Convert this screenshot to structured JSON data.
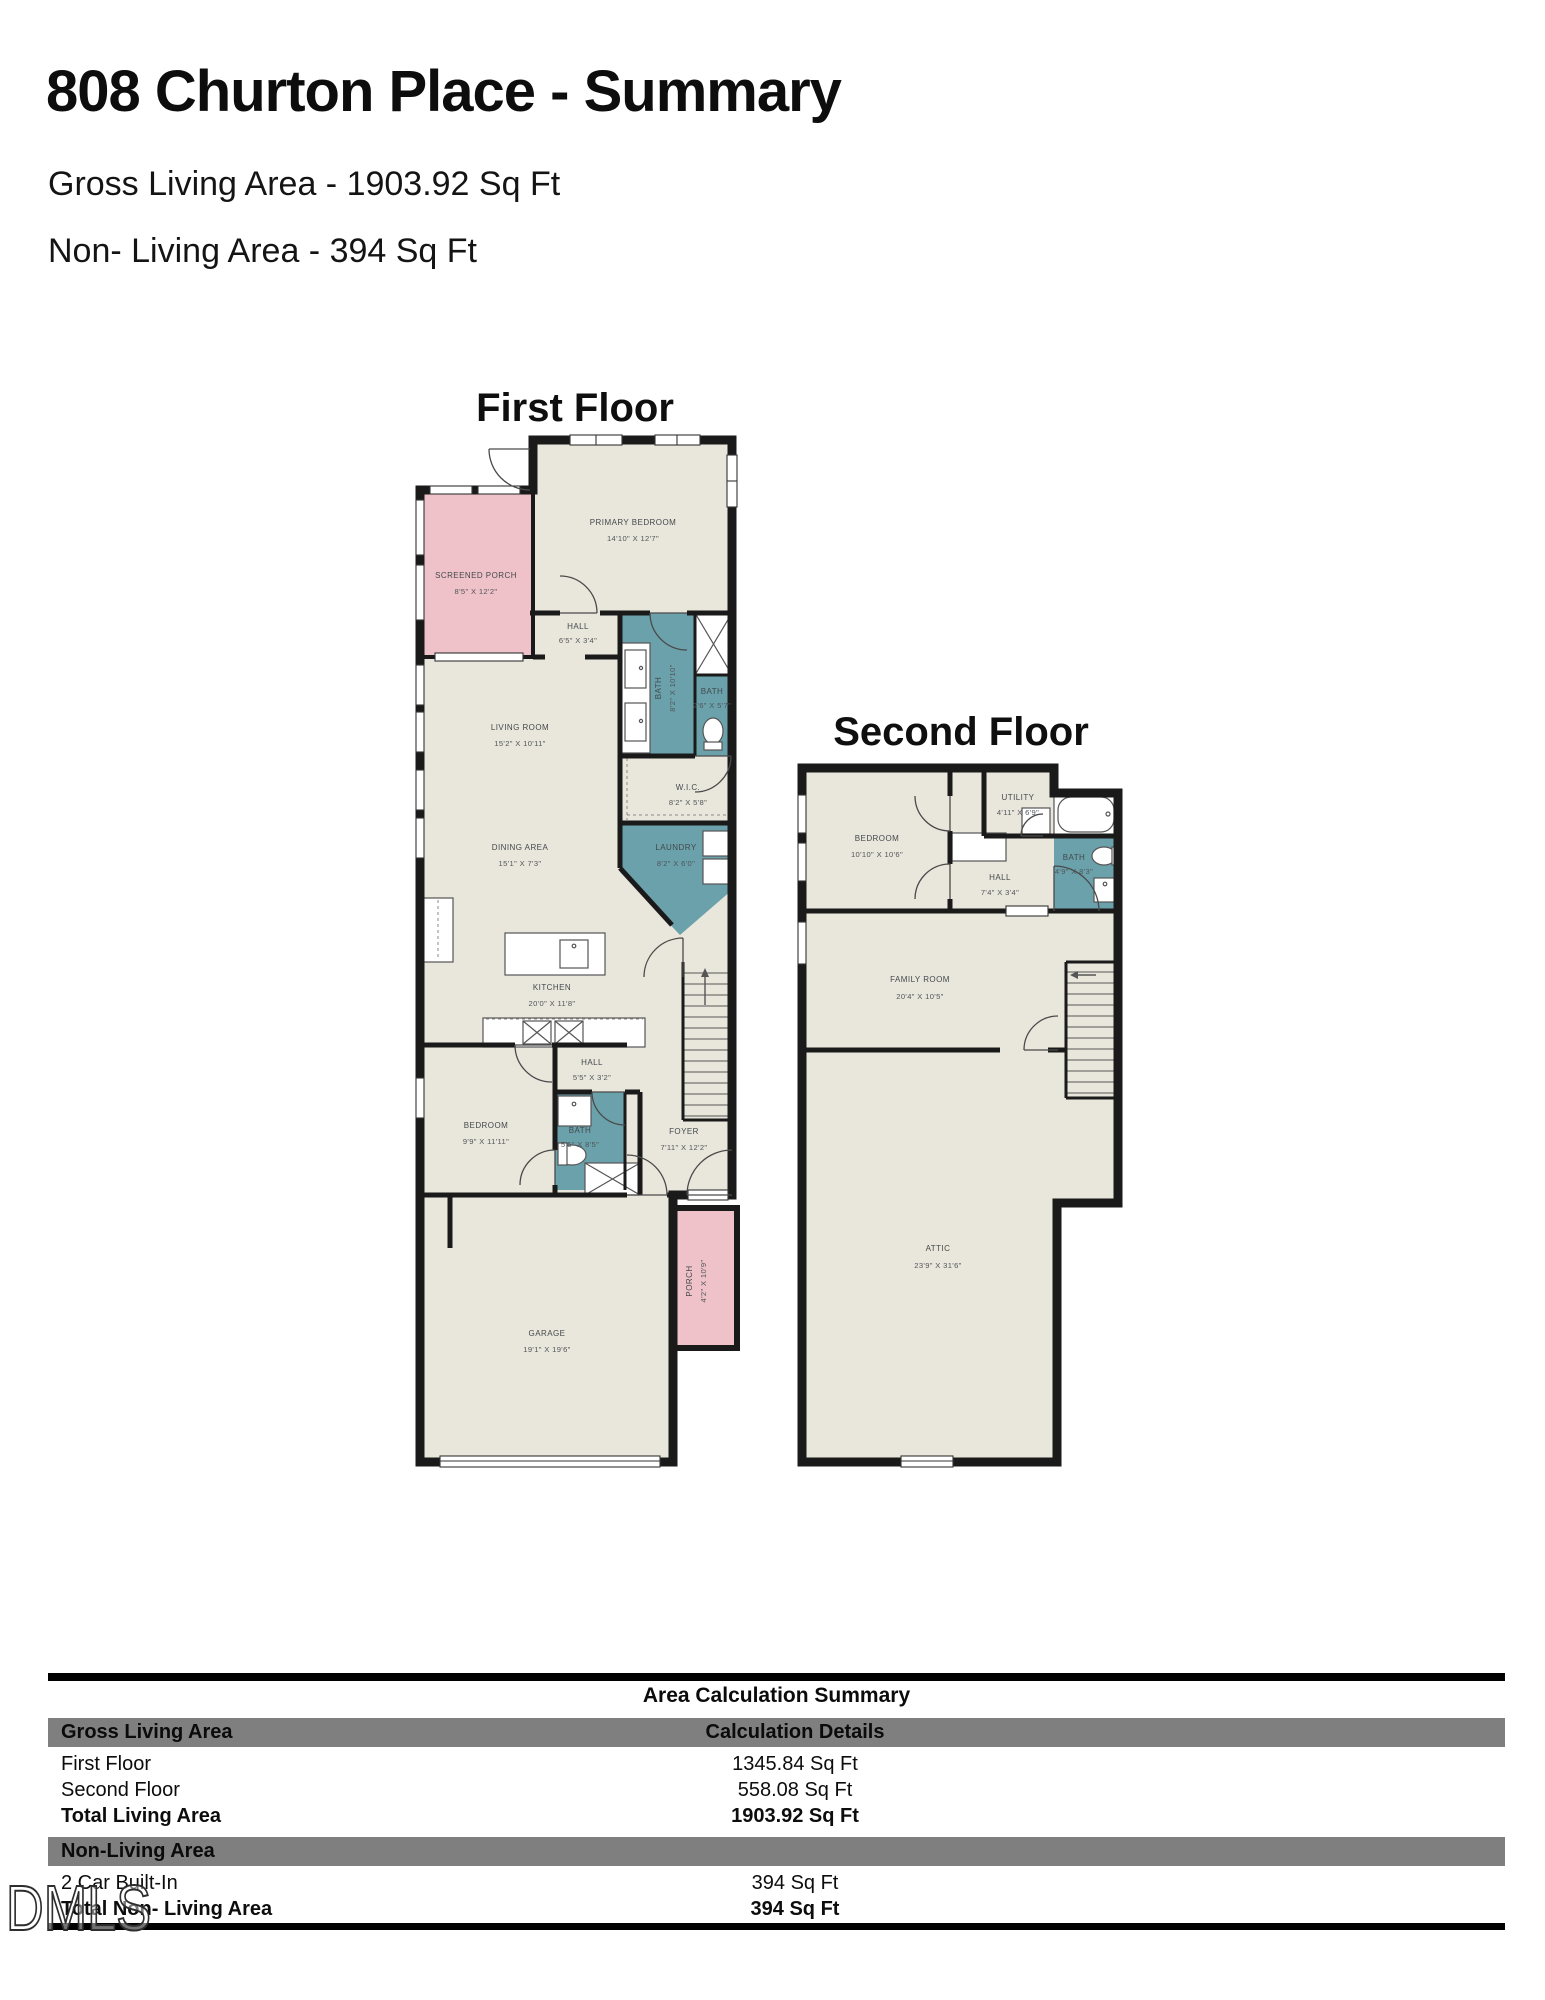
{
  "header": {
    "title": "808 Churton Place - Summary",
    "subtitle_gross": "Gross Living Area - 1903.92 Sq Ft",
    "subtitle_nonliving": "Non- Living Area - 394 Sq Ft"
  },
  "first_floor": {
    "heading": "First Floor",
    "rooms": {
      "screened_porch": {
        "name": "SCREENED PORCH",
        "dims": "8'5\" X 12'2\""
      },
      "primary_bedroom": {
        "name": "PRIMARY BEDROOM",
        "dims": "14'10\" X 12'7\""
      },
      "hall_upper": {
        "name": "HALL",
        "dims": "6'5\" X 3'4\""
      },
      "bath_primary": {
        "name": "BATH",
        "dims": "8'2\" X 10'10\""
      },
      "bath_small": {
        "name": "BATH",
        "dims": "2'6\" X 5'7\""
      },
      "living_room": {
        "name": "LIVING ROOM",
        "dims": "15'2\" X 10'11\""
      },
      "wic": {
        "name": "W.I.C.",
        "dims": "8'2\" X 5'8\""
      },
      "dining_area": {
        "name": "DINING AREA",
        "dims": "15'1\" X 7'3\""
      },
      "laundry": {
        "name": "LAUNDRY",
        "dims": "8'2\" X 6'0\""
      },
      "kitchen": {
        "name": "KITCHEN",
        "dims": "20'0\" X 11'8\""
      },
      "hall_lower": {
        "name": "HALL",
        "dims": "5'5\" X 3'2\""
      },
      "bedroom": {
        "name": "BEDROOM",
        "dims": "9'9\" X 11'11\""
      },
      "bath_hall": {
        "name": "BATH",
        "dims": "5'5\" X 8'5\""
      },
      "foyer": {
        "name": "FOYER",
        "dims": "7'11\" X 12'2\""
      },
      "garage": {
        "name": "GARAGE",
        "dims": "19'1\" X 19'6\""
      },
      "porch": {
        "name": "PORCH",
        "dims": "4'2\" X 10'9\""
      }
    }
  },
  "second_floor": {
    "heading": "Second Floor",
    "rooms": {
      "bedroom": {
        "name": "BEDROOM",
        "dims": "10'10\" X 10'6\""
      },
      "utility": {
        "name": "UTILITY",
        "dims": "4'11\" X 6'9\""
      },
      "hall": {
        "name": "HALL",
        "dims": "7'4\" X 3'4\""
      },
      "bath": {
        "name": "BATH",
        "dims": "4'9\" X 8'3\""
      },
      "family_room": {
        "name": "FAMILY ROOM",
        "dims": "20'4\" X 10'5\""
      },
      "attic": {
        "name": "ATTIC",
        "dims": "23'9\" X 31'6\""
      }
    }
  },
  "summary_table": {
    "title": "Area Calculation Summary",
    "living_header": "Gross Living Area",
    "details_header": "Calculation Details",
    "rows": {
      "first_floor": {
        "label": "First Floor",
        "value": "1345.84 Sq Ft"
      },
      "second_floor": {
        "label": "Second Floor",
        "value": "558.08 Sq Ft"
      },
      "total_living": {
        "label": "Total Living Area",
        "value": "1903.92 Sq Ft"
      },
      "nonliving_header": "Non-Living Area",
      "garage": {
        "label": "2 Car Built-In",
        "value": "394 Sq Ft"
      },
      "total_nonliving": {
        "label": "Total Non- Living Area",
        "value": "394 Sq Ft"
      }
    }
  },
  "watermark": "DMLS",
  "colors": {
    "room_fill": "#e9e6dc",
    "bath_fill": "#6aa1ab",
    "porch_fill": "#eec2c8",
    "wall": "#1a1a1a",
    "table_header_gray": "#7f7f7f"
  }
}
